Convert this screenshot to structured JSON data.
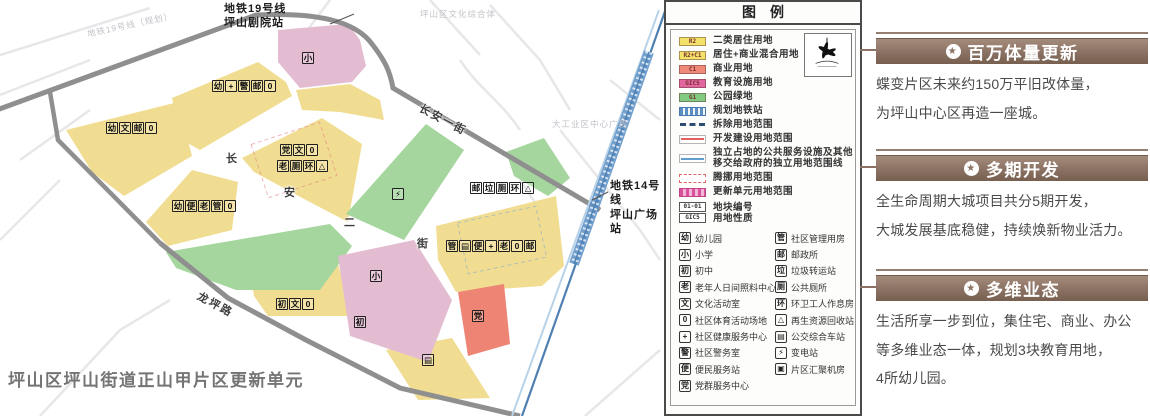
{
  "map": {
    "caption": "坪山区坪山街道正山甲片区更新单元",
    "labels": [
      {
        "text": "地铁19号线\n坪山剧院站",
        "x": 224,
        "y": 2,
        "cls": "metro-label",
        "name": "metro-line19-station-label"
      },
      {
        "text": "地铁19号线（规划）",
        "x": 86,
        "y": 28,
        "cls": "ghost",
        "rot": -12,
        "name": "metro-line19-planned-label"
      },
      {
        "text": "长安一街",
        "x": 424,
        "y": 100,
        "cls": "road-label",
        "rot": 28,
        "name": "road-label-changan-1st"
      },
      {
        "text": "长",
        "x": 226,
        "y": 150,
        "cls": "road-label",
        "name": "road-label-changan-2nd-char"
      },
      {
        "text": "安",
        "x": 284,
        "y": 184,
        "cls": "road-label",
        "name": "road-label-changan-2nd-char"
      },
      {
        "text": "二",
        "x": 344,
        "y": 214,
        "cls": "road-label",
        "name": "road-label-changan-2nd-char"
      },
      {
        "text": "街",
        "x": 417,
        "y": 235,
        "cls": "road-label",
        "name": "road-label-changan-2nd-char"
      },
      {
        "text": "龙坪路",
        "x": 202,
        "y": 288,
        "cls": "road-label",
        "rot": 28,
        "name": "road-label-longping"
      },
      {
        "text": "地铁14号线\n坪山广场站",
        "x": 610,
        "y": 179,
        "cls": "metro-label",
        "name": "metro-line14-station-label"
      },
      {
        "text": "坪山区文化综合体",
        "x": 420,
        "y": 8,
        "cls": "ghost",
        "name": "background-place-label"
      },
      {
        "text": "大工业区中心广场",
        "x": 552,
        "y": 118,
        "cls": "ghost",
        "name": "background-place-label"
      }
    ],
    "icon_clusters": [
      {
        "x": 212,
        "y": 80,
        "glyphs": [
          "幼",
          "+",
          "警",
          "邮",
          "0"
        ]
      },
      {
        "x": 106,
        "y": 122,
        "glyphs": [
          "幼",
          "文",
          "邮",
          "0"
        ]
      },
      {
        "x": 280,
        "y": 144,
        "glyphs": [
          "党",
          "文",
          "0"
        ]
      },
      {
        "x": 277,
        "y": 160,
        "glyphs": [
          "老",
          "厕",
          "环",
          "△"
        ]
      },
      {
        "x": 172,
        "y": 200,
        "glyphs": [
          "幼",
          "便",
          "老",
          "管",
          "0"
        ]
      },
      {
        "x": 470,
        "y": 182,
        "glyphs": [
          "邮",
          "垃",
          "厕",
          "环",
          "△"
        ]
      },
      {
        "x": 446,
        "y": 240,
        "glyphs": [
          "管",
          "▤",
          "便",
          "+",
          "老",
          "0",
          "邮"
        ]
      },
      {
        "x": 276,
        "y": 298,
        "glyphs": [
          "初",
          "文",
          "0"
        ]
      },
      {
        "x": 392,
        "y": 188,
        "glyphs": [
          "⚡"
        ]
      },
      {
        "x": 302,
        "y": 52,
        "glyphs": [
          "小"
        ]
      },
      {
        "x": 370,
        "y": 270,
        "glyphs": [
          "小"
        ]
      },
      {
        "x": 354,
        "y": 316,
        "glyphs": [
          "初"
        ]
      },
      {
        "x": 472,
        "y": 310,
        "glyphs": [
          "党"
        ]
      },
      {
        "x": 422,
        "y": 354,
        "glyphs": [
          "▤"
        ]
      }
    ]
  },
  "legend": {
    "title": "图例",
    "landuse": [
      {
        "code": "R2",
        "color": "#f3e269",
        "label": "二类居住用地"
      },
      {
        "code": "R2+C1",
        "color": "#f3e269",
        "label": "居住+商业混合用地"
      },
      {
        "code": "C1",
        "color": "#ef8a7b",
        "label": "商业用地"
      },
      {
        "code": "GIC5",
        "color": "#e2679f",
        "label": "教育设施用地"
      },
      {
        "code": "G1",
        "color": "#82ca82",
        "label": "公园绿地"
      }
    ],
    "lines": [
      {
        "style": "metro-station",
        "label": "规划地铁站"
      },
      {
        "style": "demolish",
        "label": "拆除用地范围"
      },
      {
        "style": "develop",
        "label": "开发建设用地范围"
      },
      {
        "style": "independent",
        "label": "独立占地的公共服务设施及其他\n移交给政府的独立用地范围线"
      },
      {
        "style": "relocate",
        "label": "腾挪用地范围"
      },
      {
        "style": "unit-boundary",
        "label": "更新单元用地范围"
      }
    ],
    "plot": {
      "number": "01-01",
      "nature": "GIC5",
      "number_label": "地块编号",
      "nature_label": "用地性质"
    },
    "facilities_left": [
      {
        "glyph": "幼",
        "label": "幼儿园"
      },
      {
        "glyph": "小",
        "label": "小学"
      },
      {
        "glyph": "初",
        "label": "初中"
      },
      {
        "glyph": "老",
        "label": "老年人日间照料中心"
      },
      {
        "glyph": "文",
        "label": "文化活动室"
      },
      {
        "glyph": "0",
        "label": "社区体育活动场地"
      },
      {
        "glyph": "+",
        "label": "社区健康服务中心"
      },
      {
        "glyph": "警",
        "label": "社区警务室"
      },
      {
        "glyph": "便",
        "label": "便民服务站"
      },
      {
        "glyph": "党",
        "label": "党群服务中心"
      }
    ],
    "facilities_right": [
      {
        "glyph": "管",
        "label": "社区管理用房"
      },
      {
        "glyph": "邮",
        "label": "邮政所"
      },
      {
        "glyph": "垃",
        "label": "垃圾转运站"
      },
      {
        "glyph": "厕",
        "label": "公共厕所"
      },
      {
        "glyph": "环",
        "label": "环卫工人作息房"
      },
      {
        "glyph": "△",
        "label": "再生资源回收站"
      },
      {
        "glyph": "▤",
        "label": "公交综合车站"
      },
      {
        "glyph": "⚡",
        "label": "变电站"
      },
      {
        "glyph": "▣",
        "label": "片区汇聚机房"
      }
    ]
  },
  "panels": [
    {
      "title": "百万体量更新",
      "body": "蝶变片区未来约150万平旧改体量，\n为坪山中心区再造一座城。"
    },
    {
      "title": "多期开发",
      "body": "全生命周期大城项目共分5期开发，\n大城发展基底稳健，持续焕新物业活力。"
    },
    {
      "title": "多维业态",
      "body": "生活所享一步到位，集住宅、商业、办公\n等多维业态一体，规划3块教育用地，\n4所幼儿园。"
    }
  ],
  "colors": {
    "parcel_residential": "#f1dd92",
    "parcel_education": "#e4bcd2",
    "parcel_commercial": "#ee8474",
    "parcel_green": "#a5d69e",
    "road_gray": "#8f8f8f",
    "metro_blue": "#4f80b2",
    "panel_brown": "#8a7163"
  }
}
